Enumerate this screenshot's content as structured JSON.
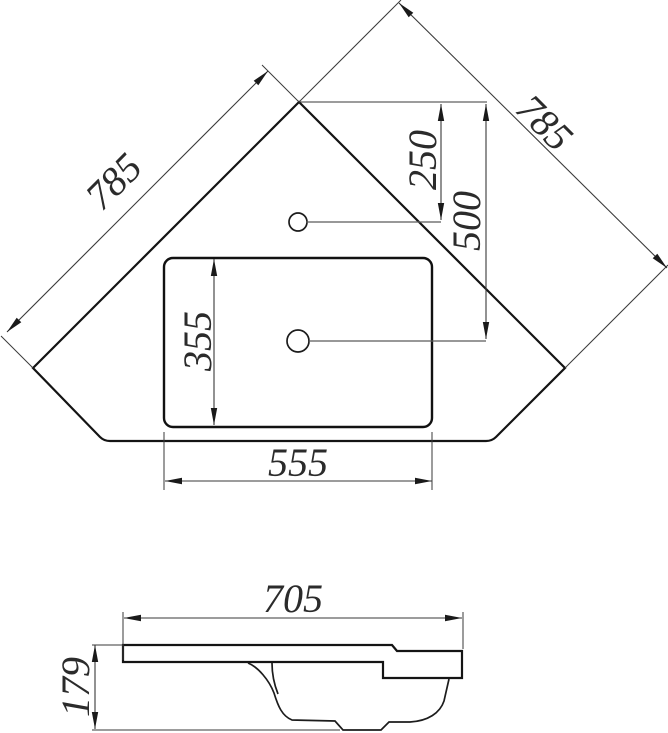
{
  "page": {
    "background": "#ffffff"
  },
  "drawing": {
    "type": "technical drawing",
    "subject": "corner washbasin - plan view (top) and side profile view (bottom)",
    "colors": {
      "outline": "#141414",
      "dimension_lines": "#3a3a3a",
      "leader_lines": "#5a5a5a",
      "text": "#2b2b2b"
    },
    "top_view": {
      "dims": {
        "left_edge": "785",
        "right_edge": "785",
        "faucet_hole_offset": "250",
        "drain_hole_offset": "500",
        "bowl_height": "355",
        "bowl_width": "555"
      }
    },
    "side_view": {
      "dims": {
        "overall_width": "705",
        "overall_height": "179"
      }
    }
  }
}
